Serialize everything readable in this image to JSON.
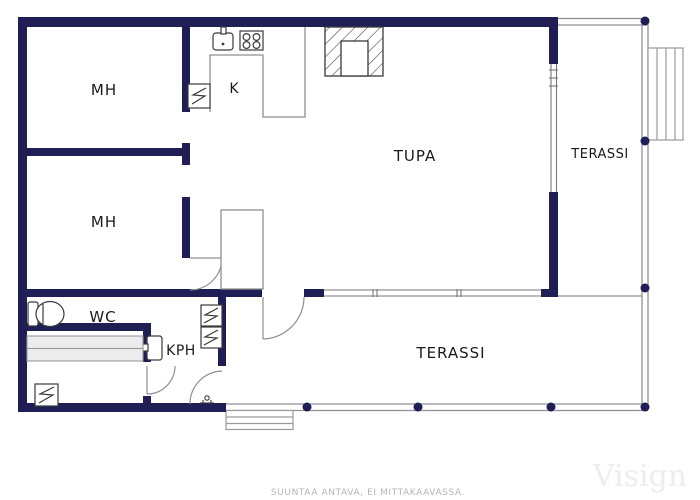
{
  "floorplan": {
    "rooms": {
      "bedroom_top": "MH",
      "bedroom_bottom": "MH",
      "kitchen": "K",
      "living_room": "TUPA",
      "terrace_right": "TERASSI",
      "terrace_bottom": "TERASSI",
      "wc": "WC",
      "bathroom": "KPH"
    },
    "caption": "SUUNTAA ANTAVA, EI MITTAKAAVASSA.",
    "watermark": "Visign",
    "colors": {
      "wall": "#1f1f56",
      "furniture_outline": "#8f8f8f",
      "fixture_outline": "#3a3a3a",
      "bench_fill": "#ececec",
      "label_text": "#1a1a1a",
      "caption_text": "#b5b5b5",
      "watermark_text": "#ededed"
    },
    "icons": {
      "heater": "square-with-zigzag",
      "sink": "basin-with-tap",
      "stove": "four-burner-hob",
      "fireplace": "hatched-block-with-hearth",
      "toilet": "cistern-and-bowl",
      "washbasin": "basin-with-tap",
      "floor_drain": "small-drain-glyph",
      "terrace_post": "navy-dot",
      "stairs": "stepped-lines"
    }
  }
}
